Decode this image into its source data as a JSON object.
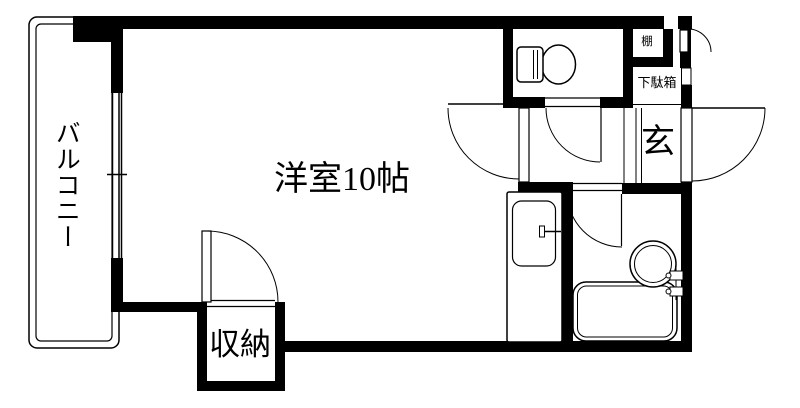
{
  "plan": {
    "labels": {
      "room": "洋室10帖",
      "balcony": "バルコニー",
      "closet": "収納",
      "entrance": "玄",
      "shoe_cabinet": "下駄箱",
      "shelf": "棚"
    },
    "colors": {
      "line": "#000000",
      "background": "#ffffff"
    },
    "fixtures": [
      "toilet-icon",
      "kitchen-sink-icon",
      "bathtub-icon",
      "washbasin-icon",
      "window-icon",
      "door-swing-icon",
      "balcony-railing-icon"
    ]
  }
}
